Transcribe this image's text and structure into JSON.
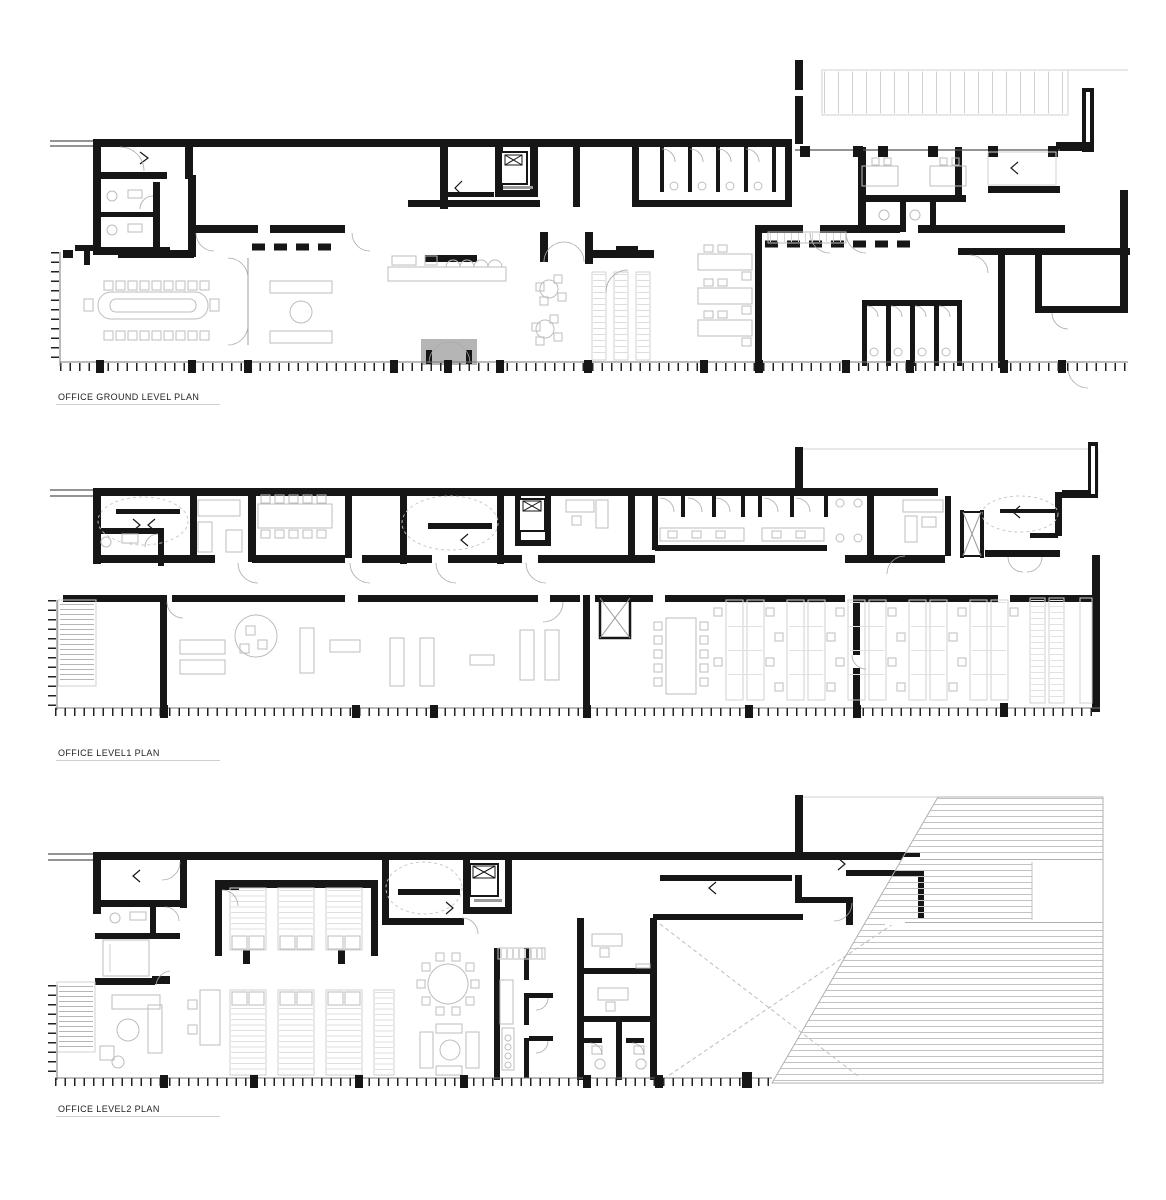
{
  "sheet": {
    "background": "#ffffff",
    "width": 1166,
    "height": 1200
  },
  "plans": [
    {
      "id": "ground",
      "label": "OFFICE GROUND LEVEL PLAN",
      "features": [
        "entrance-mat",
        "conference-room",
        "reception-counter",
        "lounge",
        "cafe-tables",
        "library-shelving",
        "toilets",
        "elevator",
        "stairs",
        "parking-strip",
        "canopy"
      ]
    },
    {
      "id": "level1",
      "label": "OFFICE LEVEL1 PLAN",
      "features": [
        "meeting-room",
        "open-plan-desks",
        "toilets",
        "kitchen",
        "elevator",
        "stairs",
        "fire-escape-stair",
        "storage-racks"
      ]
    },
    {
      "id": "level2",
      "label": "OFFICE LEVEL2 PLAN",
      "features": [
        "archive-shelving",
        "lounge",
        "kitchen",
        "round-table",
        "elevator",
        "stairs",
        "void",
        "roof-terrace-decking"
      ]
    }
  ],
  "colors": {
    "wall": "#161616",
    "furniture": "#bdbdbd",
    "stair_tread": "#9a9a9a",
    "deck_stripe": "#c3c3c3",
    "entrance_mat": "#b5b5b5",
    "label_text": "#222222"
  }
}
